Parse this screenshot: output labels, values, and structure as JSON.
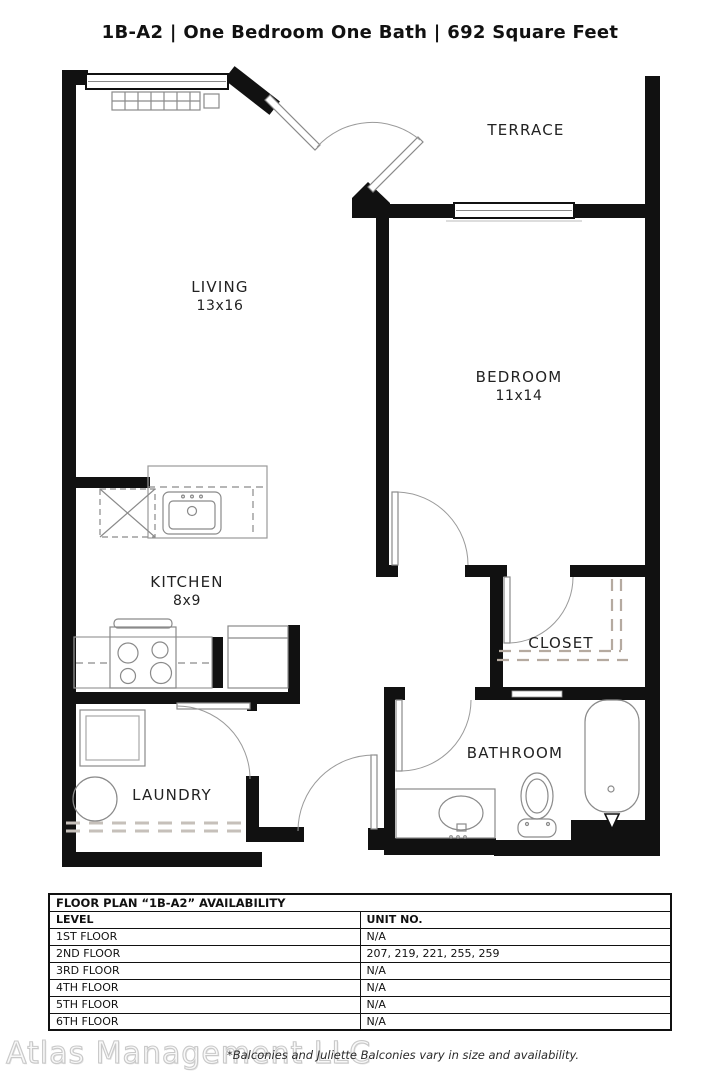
{
  "header": {
    "title": "1B-A2 | One Bedroom One Bath | 692 Square Feet"
  },
  "floor_plan": {
    "rooms": {
      "terrace": {
        "label": "TERRACE"
      },
      "living": {
        "label": "LIVING",
        "dims": "13x16"
      },
      "bedroom": {
        "label": "BEDROOM",
        "dims": "11x14"
      },
      "kitchen": {
        "label": "KITCHEN",
        "dims": "8x9"
      },
      "closet": {
        "label": "CLOSET"
      },
      "laundry": {
        "label": "LAUNDRY"
      },
      "bathroom": {
        "label": "BATHROOM"
      }
    },
    "line_colors": {
      "walls": "#111111",
      "fixtures": "#8a8a8a",
      "closet_dashes": "#b5aaa0"
    }
  },
  "availability_table": {
    "title": "FLOOR PLAN “1B-A2” AVAILABILITY",
    "columns": [
      "LEVEL",
      "UNIT NO."
    ],
    "rows": [
      {
        "level": "1ST FLOOR",
        "units": "N/A"
      },
      {
        "level": "2ND FLOOR",
        "units": "207, 219, 221, 255, 259"
      },
      {
        "level": "3RD FLOOR",
        "units": "N/A"
      },
      {
        "level": "4TH FLOOR",
        "units": "N/A"
      },
      {
        "level": "5TH FLOOR",
        "units": "N/A"
      },
      {
        "level": "6TH FLOOR",
        "units": "N/A"
      }
    ]
  },
  "footer": {
    "watermark": "Atlas Management LLC",
    "disclaimer": "*Balconies and Juliette Balconies vary in size and availability."
  }
}
